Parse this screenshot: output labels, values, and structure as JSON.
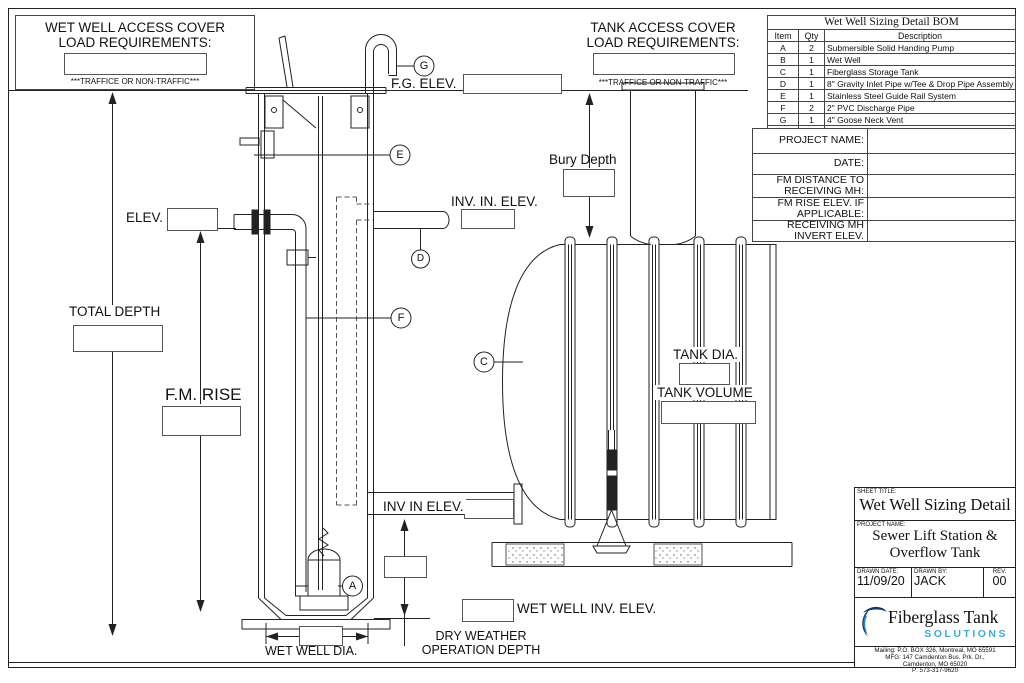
{
  "colors": {
    "line": "#222222",
    "logo_solutions_blue": "#3FA9D5",
    "logo_navy": "#14365A",
    "logo_mid_blue": "#2D86C8"
  },
  "cover_notes": {
    "wet_well": {
      "title1": "WET WELL ACCESS COVER",
      "title2": "LOAD REQUIREMENTS:",
      "traffic": "***TRAFFICE OR NON-TRAFFIC***"
    },
    "tank": {
      "title1": "TANK ACCESS COVER",
      "title2": "LOAD REQUIREMENTS:",
      "traffic": "***TRAFFICE OR NON-TRAFFIC***"
    }
  },
  "bom": {
    "title": "Wet Well  Sizing Detail BOM",
    "col_item": "Item",
    "col_qty": "Qty",
    "col_desc": "Description",
    "rows": [
      {
        "item": "A",
        "qty": "2",
        "description": "Submersible Solid Handing Pump"
      },
      {
        "item": "B",
        "qty": "1",
        "description": "Wet Well"
      },
      {
        "item": "C",
        "qty": "1",
        "description": "Fiberglass Storage Tank"
      },
      {
        "item": "D",
        "qty": "1",
        "description": "8\" Gravity Inlet Pipe w/Tee & Drop Pipe Assembly"
      },
      {
        "item": "E",
        "qty": "1",
        "description": "Stainless Steel Guide Rail System"
      },
      {
        "item": "F",
        "qty": "2",
        "description": "2\" PVC Discharge Pipe"
      },
      {
        "item": "G",
        "qty": "1",
        "description": "4\" Goose Neck Vent"
      }
    ]
  },
  "project_info": {
    "rows": [
      {
        "label": "PROJECT NAME:",
        "value": ""
      },
      {
        "label": "DATE:",
        "value": ""
      },
      {
        "label": "FM  DISTANCE TO RECEIVING MH:",
        "value": ""
      },
      {
        "label": "FM  RISE ELEV. IF APPLICABLE:",
        "value": ""
      },
      {
        "label": "RECEIVING MH INVERT ELEV.",
        "value": ""
      }
    ]
  },
  "labels": {
    "fg_elev": "F.G. ELEV.",
    "bury_depth": "Bury Depth",
    "inv_in_elev_upper": "INV. IN. ELEV.",
    "elev": "ELEV.",
    "total_depth": "TOTAL DEPTH",
    "fm_rise": "F.M. RISE",
    "tank_dia": "TANK DIA.",
    "tank_volume": "TANK VOLUME",
    "inv_in_elev_lower": "INV IN ELEV.",
    "wet_well_inv_elev": "WET WELL INV. ELEV.",
    "dry_weather_line1": "DRY WEATHER",
    "dry_weather_line2": "OPERATION DEPTH",
    "wet_well_dia": "WET WELL DIA."
  },
  "callouts": {
    "a": "A",
    "c": "C",
    "d": "D",
    "e": "E",
    "f": "F",
    "g": "G"
  },
  "title_block": {
    "sheet_title_label": "SHEET TITLE:",
    "sheet_title": "Wet Well Sizing Detail",
    "project_name_label": "PROJECT NAME:",
    "project_name_line1": "Sewer Lift Station &",
    "project_name_line2": "Overflow Tank",
    "drawn_date_label": "DRAWN DATE:",
    "drawn_date": "11/09/20",
    "drawn_by_label": "DRAWN BY:",
    "drawn_by": "JACK",
    "rev_label": "REV.",
    "rev": "00",
    "logo_name": "Fiberglass Tank",
    "logo_sub": "SOLUTIONS",
    "address_line1": "Mailing: P.O. BOX 326, Montreal, MO 65591",
    "address_line2": "MFG: 147 Camdenton Bus. Prk. Dr.,",
    "address_line3": "Camdenton, MO 65020",
    "address_line4": "P: 573-317-9620"
  }
}
